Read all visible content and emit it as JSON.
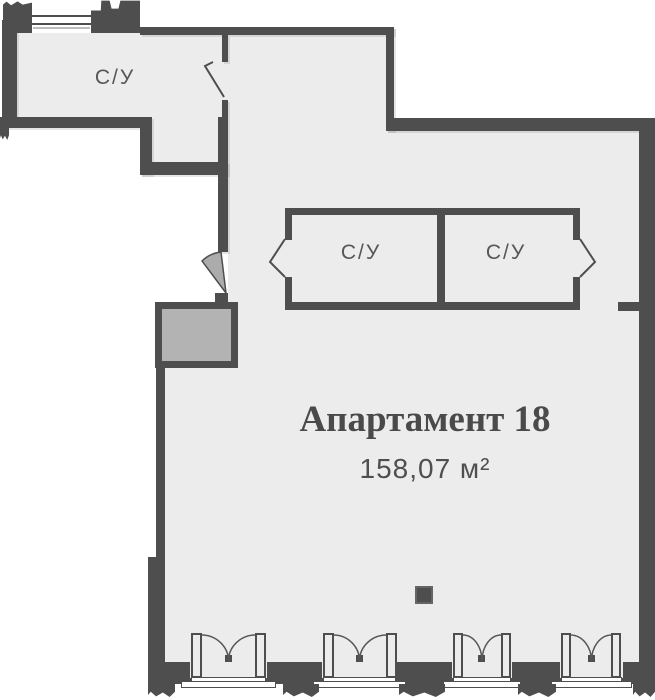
{
  "plan": {
    "title": "Апартамент 18",
    "area": "158,07 м²",
    "rooms": [
      {
        "id": "bathroom-top-left",
        "label": "С/У"
      },
      {
        "id": "bathroom-box-left",
        "label": "С/У"
      },
      {
        "id": "bathroom-box-right",
        "label": "С/У"
      }
    ],
    "colors": {
      "wall": "#4e4e4e",
      "room_fill": "#ececec",
      "shaft_fill": "#b3b3b3",
      "door_swing_fill": "#acacac",
      "text": "#4a4a4a",
      "background": "#ffffff"
    }
  }
}
